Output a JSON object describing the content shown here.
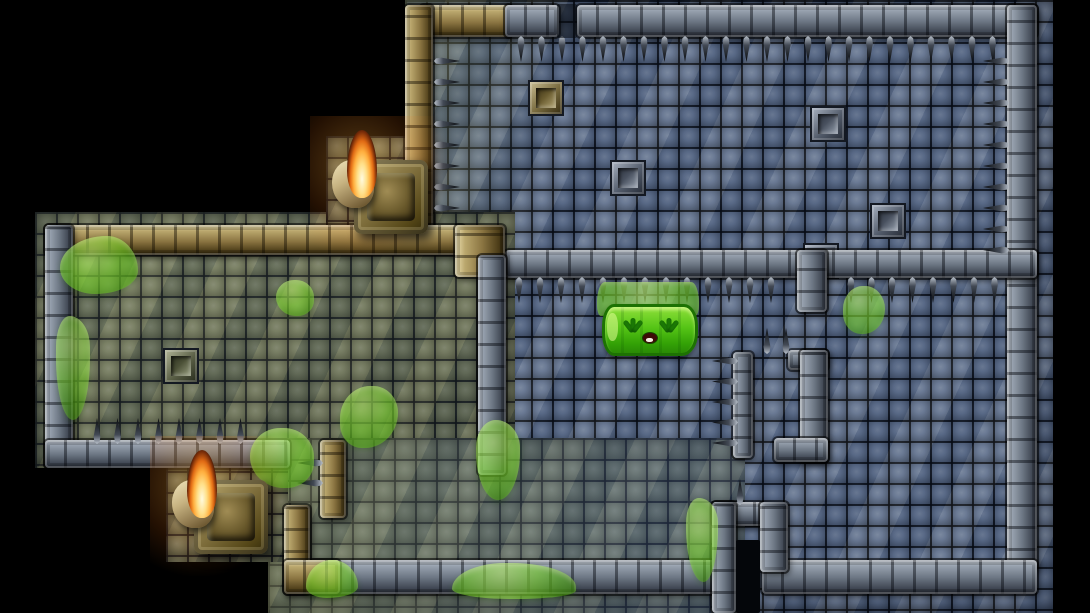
{
  "scene": {
    "title": "dungeon-room-map",
    "viewport": {
      "width": 1090,
      "height": 613,
      "void_color": "#000000"
    }
  },
  "palette": {
    "floor_blue": "#5a6b88",
    "floor_olive": "#6e7457",
    "wall_gray": "#6c7683",
    "wall_gold": "#8a7441",
    "goo_green": "#7cd62c",
    "slime_green": "#55c416",
    "flame_orange": "#ffae3e",
    "spike_dark": "#07090c"
  },
  "map": {
    "tile_size": 21,
    "floors": [
      {
        "x": 405,
        "y": 0,
        "w": 648,
        "h": 613,
        "base": "#5a6b88",
        "tint": "linear-gradient(100deg, rgba(124,128,84,0.85) 0%, rgba(124,128,84,0) 22%)"
      },
      {
        "x": 35,
        "y": 212,
        "w": 480,
        "h": 256,
        "base": "#6e7457",
        "tint": "linear-gradient(160deg, rgba(150,160,115,0.3), rgba(40,48,34,0.35))"
      },
      {
        "x": 268,
        "y": 438,
        "w": 477,
        "h": 175,
        "base": "#66705f",
        "tint": "linear-gradient(90deg, rgba(130,134,88,0.7), rgba(80,100,135,0.55) 80%)"
      },
      {
        "x": 326,
        "y": 136,
        "w": 86,
        "h": 100,
        "base": "#6e7457",
        "tint": ""
      },
      {
        "x": 166,
        "y": 450,
        "w": 122,
        "h": 112,
        "base": "#6b7152",
        "tint": ""
      }
    ],
    "walls": [
      {
        "x": 420,
        "y": 5,
        "w": 92,
        "h": 32,
        "style": "gold"
      },
      {
        "x": 405,
        "y": 5,
        "w": 28,
        "h": 230,
        "style": "gold"
      },
      {
        "x": 505,
        "y": 5,
        "w": 54,
        "h": 32,
        "style": "gray"
      },
      {
        "x": 577,
        "y": 5,
        "w": 460,
        "h": 32,
        "style": "gray"
      },
      {
        "x": 1007,
        "y": 5,
        "w": 30,
        "h": 565,
        "style": "gray"
      },
      {
        "x": 505,
        "y": 250,
        "w": 532,
        "h": 28,
        "style": "gray"
      },
      {
        "x": 797,
        "y": 250,
        "w": 30,
        "h": 62,
        "style": "gray"
      },
      {
        "x": 733,
        "y": 352,
        "w": 20,
        "h": 106,
        "style": "gray"
      },
      {
        "x": 788,
        "y": 350,
        "w": 40,
        "h": 20,
        "style": "gray"
      },
      {
        "x": 800,
        "y": 350,
        "w": 28,
        "h": 112,
        "style": "gray"
      },
      {
        "x": 774,
        "y": 438,
        "w": 54,
        "h": 24,
        "style": "gray"
      },
      {
        "x": 762,
        "y": 560,
        "w": 275,
        "h": 34,
        "style": "gray"
      },
      {
        "x": 310,
        "y": 560,
        "w": 405,
        "h": 34,
        "style": "gray"
      },
      {
        "x": 712,
        "y": 502,
        "w": 52,
        "h": 24,
        "style": "gray"
      },
      {
        "x": 712,
        "y": 502,
        "w": 24,
        "h": 111,
        "style": "gray"
      },
      {
        "x": 760,
        "y": 502,
        "w": 28,
        "h": 70,
        "style": "gray"
      },
      {
        "x": 45,
        "y": 225,
        "w": 420,
        "h": 30,
        "style": "gold"
      },
      {
        "x": 45,
        "y": 225,
        "w": 28,
        "h": 243,
        "style": "gray"
      },
      {
        "x": 45,
        "y": 440,
        "w": 245,
        "h": 28,
        "style": "gray"
      },
      {
        "x": 455,
        "y": 225,
        "w": 50,
        "h": 52,
        "style": "gold"
      },
      {
        "x": 478,
        "y": 255,
        "w": 28,
        "h": 220,
        "style": "gray"
      },
      {
        "x": 320,
        "y": 440,
        "w": 26,
        "h": 78,
        "style": "gold"
      },
      {
        "x": 284,
        "y": 505,
        "w": 26,
        "h": 89,
        "style": "gold"
      },
      {
        "x": 284,
        "y": 560,
        "w": 56,
        "h": 34,
        "style": "gold"
      }
    ],
    "spikes": [
      {
        "x": 516,
        "y": 36,
        "dir": "down",
        "count": 24,
        "gap": 20.5
      },
      {
        "x": 434,
        "y": 56,
        "dir": "right",
        "count": 8,
        "gap": 21
      },
      {
        "x": 983,
        "y": 56,
        "dir": "left",
        "count": 10,
        "gap": 21
      },
      {
        "x": 514,
        "y": 277,
        "dir": "down",
        "count": 13,
        "gap": 21
      },
      {
        "x": 846,
        "y": 277,
        "dir": "down",
        "count": 8,
        "gap": 20.5
      },
      {
        "x": 92,
        "y": 418,
        "dir": "up",
        "count": 8,
        "gap": 20.5
      },
      {
        "x": 712,
        "y": 356,
        "dir": "left",
        "count": 5,
        "gap": 20.5
      },
      {
        "x": 762,
        "y": 328,
        "dir": "up",
        "count": 2,
        "gap": 19
      },
      {
        "x": 297,
        "y": 458,
        "dir": "left",
        "count": 2,
        "gap": 20
      },
      {
        "x": 735,
        "y": 479,
        "dir": "up",
        "count": 1,
        "gap": 20
      }
    ],
    "decorations": [
      {
        "x": 528,
        "y": 80,
        "variant": "tan"
      },
      {
        "x": 610,
        "y": 160,
        "variant": "gray"
      },
      {
        "x": 810,
        "y": 106,
        "variant": "gray"
      },
      {
        "x": 870,
        "y": 203,
        "variant": "gray"
      },
      {
        "x": 803,
        "y": 243,
        "variant": "gray"
      },
      {
        "x": 163,
        "y": 348,
        "variant": "olive"
      }
    ],
    "goo_splats": [
      {
        "x": 60,
        "y": 236,
        "w": 78,
        "h": 58,
        "br": "60% 40% 55% 45% / 55% 60% 40% 45%",
        "op": 0.62
      },
      {
        "x": 56,
        "y": 316,
        "w": 34,
        "h": 104,
        "br": "40% 60% 50% 50% / 30% 30% 60% 60%",
        "op": 0.55
      },
      {
        "x": 276,
        "y": 280,
        "w": 38,
        "h": 36,
        "br": "50% 50% 45% 55%",
        "op": 0.6
      },
      {
        "x": 340,
        "y": 386,
        "w": 58,
        "h": 62,
        "br": "55% 45% 60% 40%",
        "op": 0.6
      },
      {
        "x": 250,
        "y": 428,
        "w": 64,
        "h": 60,
        "br": "50% 50% 45% 55%",
        "op": 0.62
      },
      {
        "x": 476,
        "y": 420,
        "w": 44,
        "h": 80,
        "br": "45% 55% 50% 50% / 35% 35% 60% 60%",
        "op": 0.6
      },
      {
        "x": 843,
        "y": 286,
        "w": 42,
        "h": 48,
        "br": "50% 50% 55% 45%",
        "op": 0.6
      },
      {
        "x": 686,
        "y": 498,
        "w": 32,
        "h": 84,
        "br": "40% 60% 45% 55% / 30% 30% 65% 65%",
        "op": 0.58
      },
      {
        "x": 306,
        "y": 560,
        "w": 52,
        "h": 38,
        "br": "50% 50% 60% 40% / 70% 70% 30% 30%",
        "op": 0.62
      },
      {
        "x": 452,
        "y": 563,
        "w": 124,
        "h": 36,
        "br": "45% 55% 50% 50% / 75% 70% 25% 30%",
        "op": 0.6
      }
    ],
    "doorways": [
      {
        "x": 736,
        "y": 540,
        "w": 24,
        "h": 73,
        "fill": "#04060a"
      },
      {
        "x": 557,
        "y": 4,
        "w": 20,
        "h": 34,
        "fill": "rgba(6,9,14,0.55)"
      }
    ],
    "torches": [
      {
        "x": 332,
        "y": 138
      },
      {
        "x": 172,
        "y": 458
      }
    ]
  },
  "entities": {
    "slime": {
      "x": 597,
      "y": 282,
      "w": 102,
      "h": 68,
      "mood": "sad",
      "color": "#55c416"
    }
  }
}
